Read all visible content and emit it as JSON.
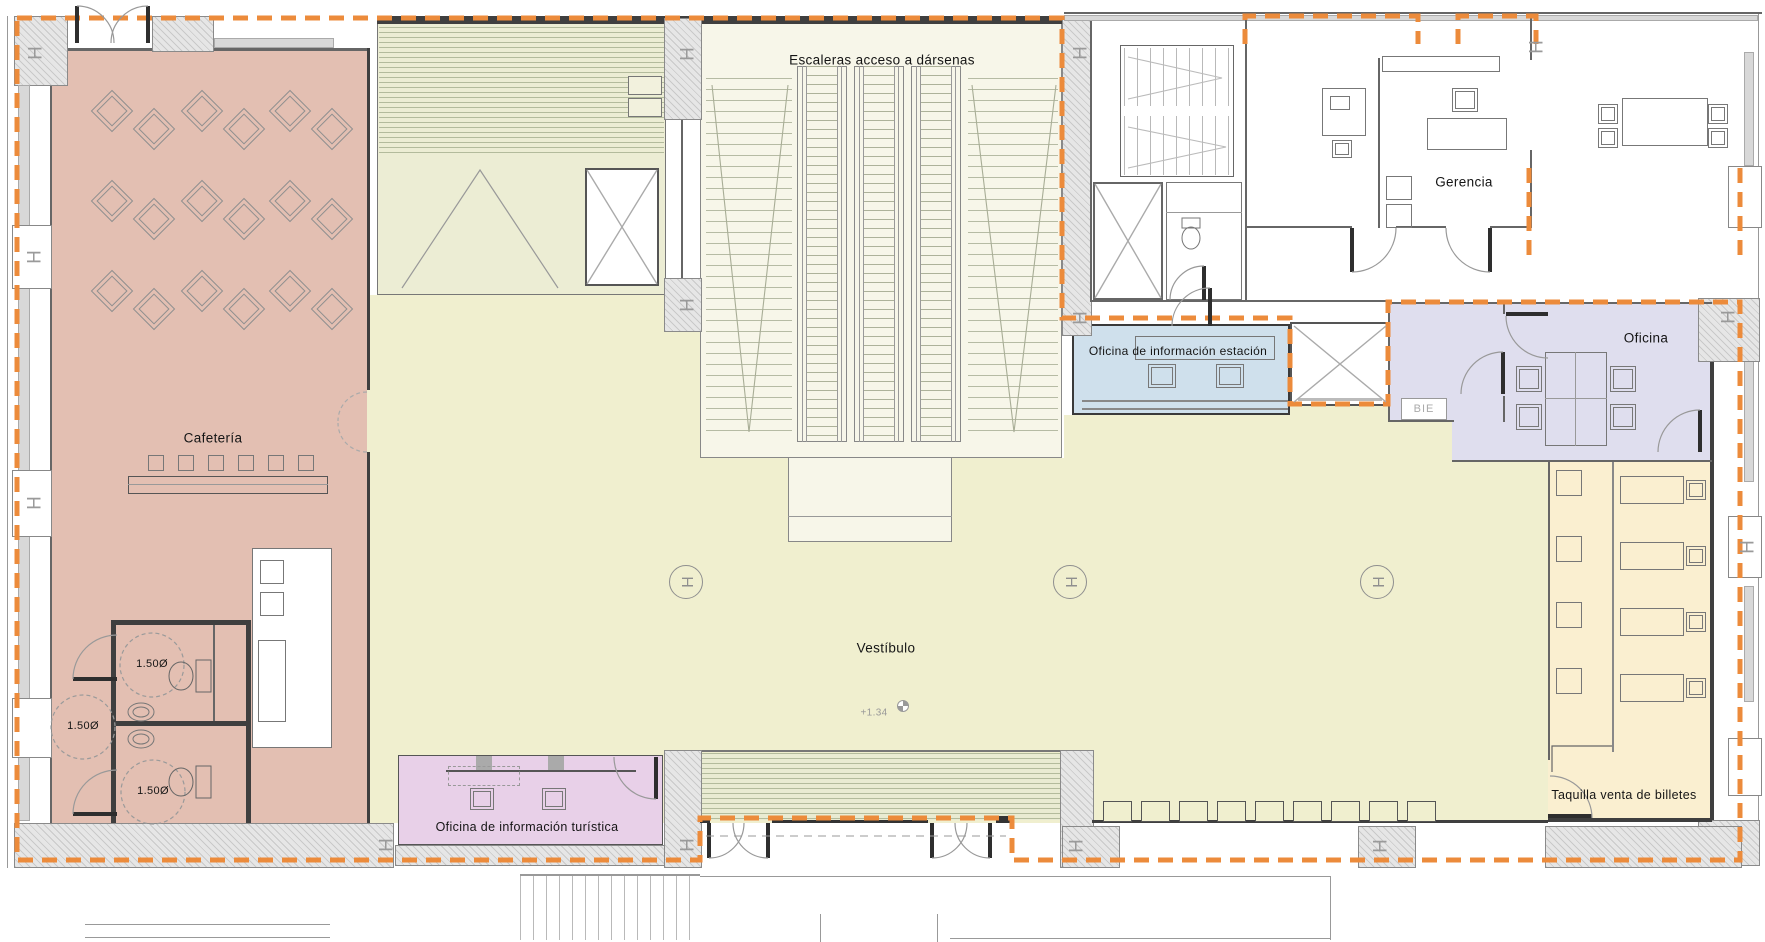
{
  "colors": {
    "boundary_orange": "#ec8b3b",
    "cafeteria": "#e3bfb2",
    "vestibule": "#f0efcf",
    "escalator_hall": "#f7f6e9",
    "service_green": "#ecedd4",
    "stripe_line": "#b3bb9c",
    "info_office_blue": "#cfe0ec",
    "office_lavender": "#dfdeee",
    "tourist_office_purple": "#e8d0e8",
    "ticket_office_tan": "#faefd0",
    "hatch_fill": "#e6e6e6",
    "hatch_line": "#c9c9c9",
    "window_gray": "#d8d8d8",
    "wall_dark": "#3f3f3f"
  },
  "rooms": {
    "cafeteria": {
      "label": "Cafetería"
    },
    "stairs_hall": {
      "label": "Escaleras acceso a dársenas"
    },
    "management": {
      "label": "Gerencia"
    },
    "station_info_office": {
      "label": "Oficina de información estación"
    },
    "office": {
      "label": "Oficina"
    },
    "lobby": {
      "label": "Vestíbulo"
    },
    "tourist_info_office": {
      "label": "Oficina de información turística"
    },
    "ticket_office": {
      "label": "Taquilla venta de billetes"
    }
  },
  "annotations": {
    "level": "+1.34",
    "bie": "BIE",
    "circle_diameter": "1.50Ø",
    "column": "H"
  }
}
